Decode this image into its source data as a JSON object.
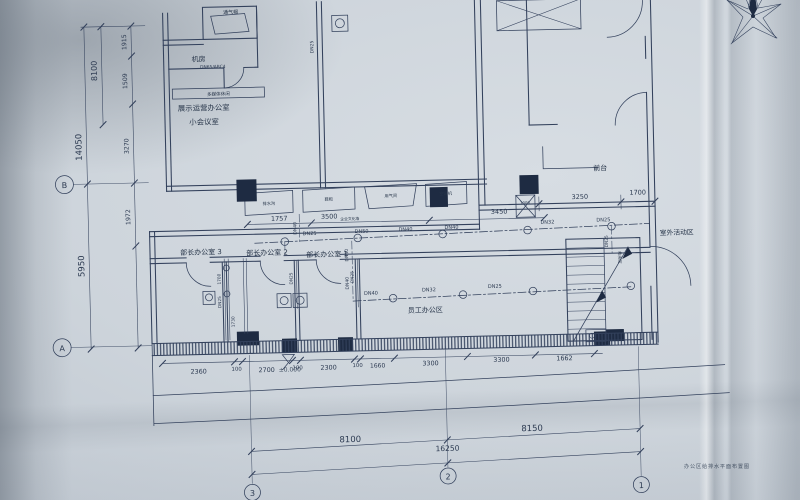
{
  "photo": {
    "caption": "办公区给排水平面布置图"
  },
  "grid": {
    "a": "A",
    "b": "B",
    "c1": "1",
    "c2": "2",
    "c3": "3"
  },
  "labels": {
    "vent_cap": "通气帽",
    "room_machine": "机房",
    "riser_note": "DN65/ABC4",
    "media_shelf": "多媒体休闲",
    "room_exhibit_1": "展示运营办公室",
    "room_exhibit_2": "小会议室",
    "office3": "部长办公室 3",
    "office2": "部长办公室 2",
    "office1": "部长办公室 1",
    "front_desk": "前台",
    "outdoor": "室外活动区",
    "staff": "员工办公区",
    "shower": "淋浴间",
    "furn_1": "排水沟",
    "furn_2": "鞋柜",
    "furn_3": "用气间",
    "furn_4": "空调机",
    "culture_wall": "企业文化墙"
  },
  "dims": {
    "left_outer": [
      "14050",
      "5950"
    ],
    "left_mid": "8100",
    "left_inner": [
      "1915",
      "1509",
      "3270",
      "1972"
    ],
    "top_chain": [
      "1757",
      "3500",
      "3450"
    ],
    "right_chain": [
      "3250",
      "1700"
    ],
    "small_1000": "1000",
    "bottom_chain": [
      "2360",
      "100",
      "2700",
      "100",
      "2300",
      "100",
      "1660",
      "3300",
      "3300",
      "1662"
    ],
    "elevation": "±0.000",
    "riser_stack": [
      "1700",
      "DN25",
      "1730"
    ],
    "overall": [
      "8100",
      "8150"
    ],
    "total": "16250"
  },
  "pipes": {
    "upper_run": [
      "DN25",
      "DN50",
      "DN40",
      "DN40",
      "DN32",
      "DN25"
    ],
    "lower_run": [
      "DN40",
      "DN32",
      "DN25"
    ],
    "shaft": "DN25",
    "v1": "DN40",
    "v2": "DN50",
    "v3": "DN40",
    "office_2": "DN25",
    "office_1": "DN25",
    "stair": "DN25"
  }
}
